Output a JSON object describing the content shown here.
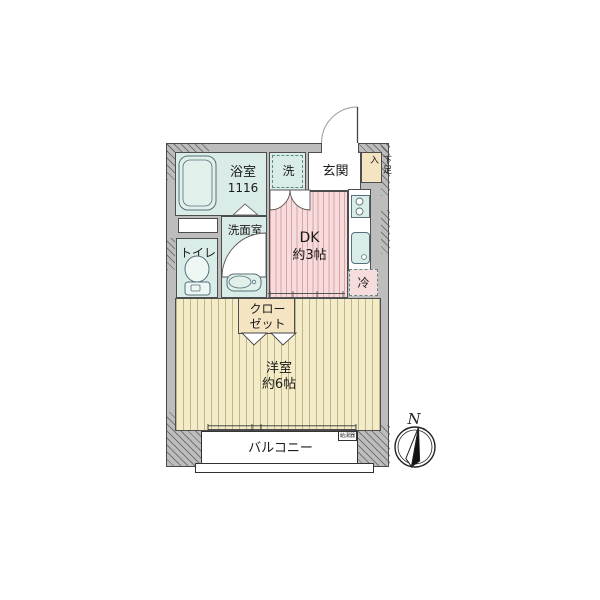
{
  "rooms": {
    "bathroom": {
      "label": "浴室",
      "size": "1116"
    },
    "washroom": {
      "label": "洗面室"
    },
    "toilet": {
      "label": "トイレ"
    },
    "washer": {
      "label": "洗"
    },
    "entrance": {
      "label": "玄関"
    },
    "shoe_box": {
      "label": "下足入"
    },
    "dk": {
      "label": "DK",
      "size": "約3帖"
    },
    "fridge": {
      "label": "冷"
    },
    "closet": {
      "line1": "クロー",
      "line2": "ゼット"
    },
    "western_room": {
      "label": "洋室",
      "size": "約6帖"
    },
    "balcony": {
      "label": "バルコニー"
    },
    "water_heater": {
      "label": "給湯器"
    }
  },
  "compass": {
    "north_label": "N"
  },
  "colors": {
    "wall": "#bdbdbd",
    "wet_area": "#d9ece8",
    "dk_floor": "#f6dcdc",
    "dk_stripe": "#dca2a2",
    "room_floor": "#f3ecc9",
    "room_stripe": "#c3b386",
    "storage": "#f4e4c2",
    "outline": "#4d4d4d"
  }
}
